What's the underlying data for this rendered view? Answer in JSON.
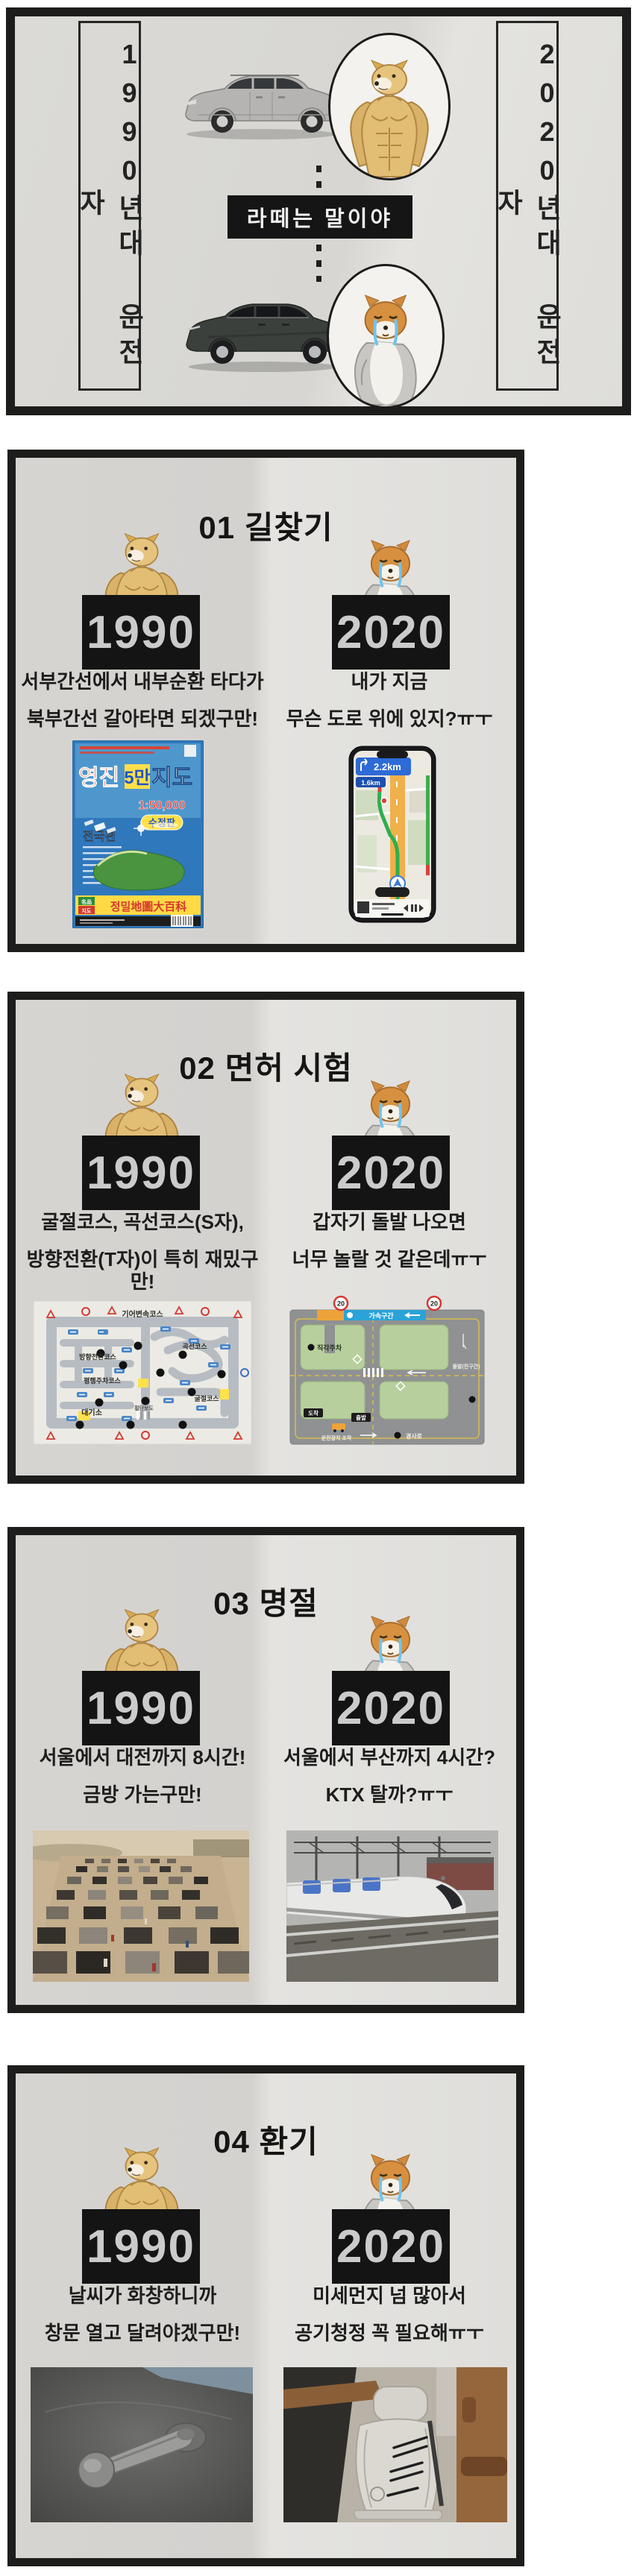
{
  "header": {
    "left_banner": "1990년대 운전자",
    "right_banner": "2020년대 운전자",
    "center_label": "라떼는 말이야"
  },
  "sections": [
    {
      "title": "01 길찾기",
      "left": {
        "year": "1990",
        "line1": "서부간선에서 내부순환 타다가",
        "line2": "북부간선 갈아타면 되겠구만!"
      },
      "right": {
        "year": "2020",
        "line1": "내가 지금",
        "line2": "무슨 도로 위에 있지?ㅠㅜ"
      }
    },
    {
      "title": "02 면허 시험",
      "left": {
        "year": "1990",
        "line1": "굴절코스, 곡선코스(S자),",
        "line2": "방향전환(T자)이 특히 재밌구만!"
      },
      "right": {
        "year": "2020",
        "line1": "갑자기 돌발 나오면",
        "line2": "너무 놀랄 것 같은데ㅠㅜ"
      }
    },
    {
      "title": "03 명절",
      "left": {
        "year": "1990",
        "line1": "서울에서 대전까지 8시간!",
        "line2": "금방 가는구만!"
      },
      "right": {
        "year": "2020",
        "line1": "서울에서 부산까지 4시간?",
        "line2": "KTX 탈까?ㅠㅜ"
      }
    },
    {
      "title": "04 환기",
      "left": {
        "year": "1990",
        "line1": "날씨가 화창하니까",
        "line2": "창문 열고 달려야겠구만!"
      },
      "right": {
        "year": "2020",
        "line1": "미세먼지 넘 많아서",
        "line2": "공기청정 꼭 필요해ㅠㅜ"
      }
    }
  ],
  "map_book": {
    "title_left": "영진",
    "title_mid": "5만",
    "title_right": "지도",
    "scale": "1:50,000",
    "edition": "수정판",
    "region": "전국편",
    "encyclopedia": "정밀地圖大百科",
    "brand_top": "名品",
    "brand_bottom": "지도"
  },
  "phone_nav": {
    "primary_distance": "2.2km",
    "secondary_distance": "1.6km"
  },
  "course_1990": {
    "gear": "기어변속코스",
    "turn": "방향전환코스",
    "curve": "곡선코스",
    "parallel": "평행주차코스",
    "angle": "굴절코스",
    "waiting": "대기소",
    "crosswalk": "횡단보도"
  },
  "course_2020": {
    "speed": "20",
    "accel": "가속구간",
    "right_angle_parking": "직각주차",
    "surprise": "돌발(전구간)",
    "slope": "경사로",
    "start": "출발",
    "finish": "도착",
    "controls": "운전장치 조작"
  },
  "colors": {
    "frame": "#1d1d1c",
    "paper_left": "#d4d2cf",
    "paper_right": "#e4e3e0",
    "badge_bg": "#141414",
    "badge_text": "#cbcbcb",
    "doge_tan": "#e2bd74",
    "cheems_orange": "#d7903f",
    "tear_blue": "#6fc4ee",
    "nav_banner_blue": "#2e6bd6",
    "nav_road_orange": "#f0b04a",
    "course_green": "#b7cf9c",
    "course_banner_blue": "#2ba3d8",
    "sign_red": "#d03a32"
  }
}
